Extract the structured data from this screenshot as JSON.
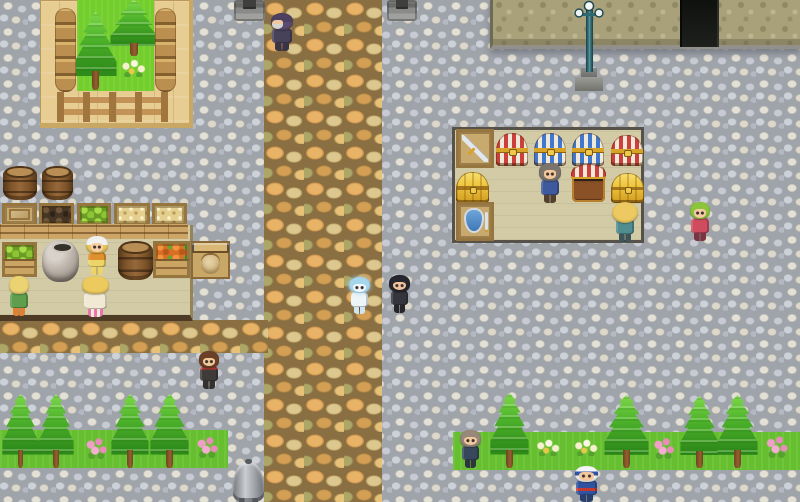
{
  "scene": {
    "width": 800,
    "height": 502,
    "style": "rpg-town"
  },
  "terrain": [
    {
      "name": "ground-cobblestone",
      "cls": "t-cobble",
      "x": 0,
      "y": 0,
      "w": 800,
      "h": 502,
      "z": 1,
      "interactable": false,
      "colors": {
        "base": "#9fa3aa"
      }
    },
    {
      "name": "main-path",
      "cls": "t-path",
      "x": 264,
      "y": 0,
      "w": 118,
      "h": 502,
      "z": 2,
      "interactable": false,
      "colors": {
        "base": "#8a6f42"
      }
    },
    {
      "name": "west-road",
      "cls": "t-path",
      "x": 0,
      "y": 320,
      "w": 268,
      "h": 33,
      "z": 2,
      "interactable": false,
      "colors": {
        "base": "#8a6f42"
      }
    },
    {
      "name": "grass-strip-left",
      "cls": "t-grass",
      "x": 0,
      "y": 430,
      "w": 228,
      "h": 38,
      "z": 2,
      "interactable": false,
      "colors": {
        "base": "#66bf2e"
      }
    },
    {
      "name": "grass-strip-right",
      "cls": "t-grass",
      "x": 453,
      "y": 432,
      "w": 347,
      "h": 38,
      "z": 2,
      "interactable": false,
      "colors": {
        "base": "#66bf2e"
      }
    },
    {
      "name": "garden-deck",
      "cls": "t-deck",
      "x": 40,
      "y": 0,
      "w": 153,
      "h": 128,
      "z": 3,
      "interactable": false,
      "colors": {
        "base": "#e7cd92"
      }
    },
    {
      "name": "garden-grass",
      "cls": "t-ggrass",
      "x": 77,
      "y": 0,
      "w": 77,
      "h": 91,
      "z": 4,
      "interactable": false,
      "colors": {
        "base": "#72ce2b"
      }
    },
    {
      "name": "market-floor",
      "cls": "t-floor floor-market",
      "x": 0,
      "y": 225,
      "w": 193,
      "h": 96,
      "z": 3,
      "interactable": false,
      "colors": {
        "base": "#d2cba6"
      }
    },
    {
      "name": "shop-floor",
      "cls": "t-floor floor-shop",
      "x": 452,
      "y": 127,
      "w": 192,
      "h": 116,
      "z": 3,
      "interactable": false,
      "colors": {
        "base": "#d2cba6"
      }
    },
    {
      "name": "building-wall",
      "cls": "t-wall",
      "x": 490,
      "y": 0,
      "w": 310,
      "h": 49,
      "z": 5,
      "interactable": false,
      "colors": {
        "base": "#a8a17a"
      }
    },
    {
      "name": "building-doorway",
      "cls": "t-door",
      "x": 680,
      "y": 0,
      "w": 39,
      "h": 47,
      "z": 6,
      "interactable": true,
      "colors": {
        "base": "#171a17"
      }
    }
  ],
  "props": [
    {
      "name": "garden-log-edge-left",
      "cls": "p-logs",
      "x": 55,
      "y": 8,
      "w": 21,
      "h": 84,
      "interactable": false
    },
    {
      "name": "garden-log-edge-right",
      "cls": "p-logs",
      "x": 155,
      "y": 8,
      "w": 21,
      "h": 84,
      "interactable": false
    },
    {
      "name": "garden-pine-tree-back",
      "cls": "p-pine",
      "x": 110,
      "y": 0,
      "w": 48,
      "h": 56,
      "interactable": false
    },
    {
      "name": "garden-pine-tree-front",
      "cls": "p-pine",
      "x": 74,
      "y": 12,
      "w": 43,
      "h": 78,
      "interactable": false
    },
    {
      "name": "garden-flowers",
      "cls": "p-flower-white",
      "x": 119,
      "y": 59,
      "w": 28,
      "h": 18,
      "interactable": false
    },
    {
      "name": "garden-fence",
      "cls": "p-fence",
      "x": 57,
      "y": 92,
      "w": 111,
      "h": 30,
      "interactable": false
    },
    {
      "name": "market-barrel-1",
      "cls": "p-barrel",
      "x": 3,
      "y": 168,
      "w": 34,
      "h": 32,
      "interactable": false
    },
    {
      "name": "market-barrel-2",
      "cls": "p-barrel",
      "x": 42,
      "y": 168,
      "w": 31,
      "h": 32,
      "interactable": false
    },
    {
      "name": "market-counter-front",
      "cls": "p-counter",
      "x": 0,
      "y": 224,
      "w": 188,
      "h": 15,
      "interactable": false
    },
    {
      "name": "market-crate-closed",
      "cls": "p-crate fill-closed",
      "x": 2,
      "y": 203,
      "w": 35,
      "h": 23,
      "interactable": true
    },
    {
      "name": "market-crate-dark-goods",
      "cls": "p-crate fill-dark",
      "x": 39,
      "y": 203,
      "w": 35,
      "h": 23,
      "interactable": true
    },
    {
      "name": "market-crate-apples",
      "cls": "p-crate fill-apples",
      "x": 77,
      "y": 203,
      "w": 34,
      "h": 23,
      "interactable": true
    },
    {
      "name": "market-crate-wheat-1",
      "cls": "p-crate fill-wheat",
      "x": 114,
      "y": 203,
      "w": 36,
      "h": 23,
      "interactable": true
    },
    {
      "name": "market-crate-wheat-2",
      "cls": "p-crate fill-wheat",
      "x": 152,
      "y": 203,
      "w": 35,
      "h": 23,
      "interactable": true
    },
    {
      "name": "market-crate-apples-floor",
      "cls": "p-crate fill-apples crate-tall",
      "x": 2,
      "y": 242,
      "w": 35,
      "h": 35,
      "interactable": true
    },
    {
      "name": "market-ceramic-pot",
      "cls": "p-pot",
      "x": 42,
      "y": 240,
      "w": 37,
      "h": 42,
      "interactable": false
    },
    {
      "name": "market-barrel-3",
      "cls": "p-barrel",
      "x": 118,
      "y": 243,
      "w": 35,
      "h": 37,
      "interactable": false
    },
    {
      "name": "market-crate-carrots",
      "cls": "p-crate fill-carrots crate-tall",
      "x": 153,
      "y": 241,
      "w": 37,
      "h": 37,
      "interactable": true
    },
    {
      "name": "market-sack-stand",
      "cls": "p-stand",
      "x": 191,
      "y": 241,
      "w": 39,
      "h": 38,
      "interactable": true
    },
    {
      "name": "shop-crate-sword",
      "cls": "p-crate fill-sword",
      "x": 456,
      "y": 129,
      "w": 38,
      "h": 39,
      "interactable": true
    },
    {
      "name": "shop-chest-red-1",
      "cls": "p-chest chest-red",
      "x": 496,
      "y": 133,
      "w": 32,
      "h": 33,
      "interactable": true
    },
    {
      "name": "shop-chest-blue-1",
      "cls": "p-chest chest-blue",
      "x": 534,
      "y": 133,
      "w": 32,
      "h": 33,
      "interactable": true
    },
    {
      "name": "shop-chest-blue-2",
      "cls": "p-chest chest-blue",
      "x": 572,
      "y": 133,
      "w": 32,
      "h": 33,
      "interactable": true
    },
    {
      "name": "shop-chest-red-2",
      "cls": "p-chest chest-red",
      "x": 611,
      "y": 135,
      "w": 32,
      "h": 31,
      "interactable": true
    },
    {
      "name": "shop-chest-gold-1",
      "cls": "p-chest chest-gold",
      "x": 456,
      "y": 172,
      "w": 33,
      "h": 31,
      "interactable": true
    },
    {
      "name": "shop-chest-open-red",
      "cls": "p-chest chest-open",
      "x": 572,
      "y": 167,
      "w": 33,
      "h": 35,
      "interactable": true
    },
    {
      "name": "shop-chest-gold-2",
      "cls": "p-chest chest-gold",
      "x": 611,
      "y": 173,
      "w": 33,
      "h": 30,
      "interactable": true
    },
    {
      "name": "shop-crate-shield",
      "cls": "p-crate fill-shield",
      "x": 456,
      "y": 202,
      "w": 38,
      "h": 39,
      "interactable": true
    },
    {
      "name": "stone-pedestal-left",
      "cls": "p-pedestal",
      "x": 234,
      "y": 0,
      "w": 31,
      "h": 21,
      "interactable": false
    },
    {
      "name": "stone-pedestal-right",
      "cls": "p-pedestal",
      "x": 387,
      "y": 0,
      "w": 30,
      "h": 21,
      "interactable": false
    },
    {
      "name": "lamppost",
      "cls": "p-lamp",
      "x": 570,
      "y": 0,
      "w": 38,
      "h": 91,
      "interactable": false
    },
    {
      "name": "pine-tree-sw-1",
      "cls": "p-pine",
      "x": 2,
      "y": 394,
      "w": 37,
      "h": 74,
      "interactable": false
    },
    {
      "name": "pine-tree-sw-2",
      "cls": "p-pine",
      "x": 38,
      "y": 394,
      "w": 36,
      "h": 74,
      "interactable": false
    },
    {
      "name": "pine-tree-sw-3",
      "cls": "p-pine",
      "x": 111,
      "y": 394,
      "w": 38,
      "h": 74,
      "interactable": false
    },
    {
      "name": "pine-tree-sw-4",
      "cls": "p-pine",
      "x": 150,
      "y": 394,
      "w": 39,
      "h": 74,
      "interactable": false
    },
    {
      "name": "pine-tree-se-1",
      "cls": "p-pine",
      "x": 490,
      "y": 393,
      "w": 39,
      "h": 75,
      "interactable": false
    },
    {
      "name": "pine-tree-se-2",
      "cls": "p-pine",
      "x": 604,
      "y": 395,
      "w": 45,
      "h": 73,
      "interactable": false
    },
    {
      "name": "pine-tree-se-3",
      "cls": "p-pine",
      "x": 680,
      "y": 396,
      "w": 39,
      "h": 72,
      "interactable": false
    },
    {
      "name": "pine-tree-se-4",
      "cls": "p-pine",
      "x": 717,
      "y": 395,
      "w": 41,
      "h": 73,
      "interactable": false
    },
    {
      "name": "flowers-pink-1",
      "cls": "p-flower-pink",
      "x": 84,
      "y": 437,
      "w": 24,
      "h": 22,
      "interactable": false
    },
    {
      "name": "flowers-pink-2",
      "cls": "p-flower-pink",
      "x": 195,
      "y": 436,
      "w": 24,
      "h": 22,
      "interactable": false
    },
    {
      "name": "flowers-white-1",
      "cls": "p-flower-white",
      "x": 534,
      "y": 439,
      "w": 27,
      "h": 17,
      "interactable": false
    },
    {
      "name": "flowers-white-2",
      "cls": "p-flower-white",
      "x": 572,
      "y": 439,
      "w": 27,
      "h": 17,
      "interactable": false
    },
    {
      "name": "flowers-pink-3",
      "cls": "p-flower-pink",
      "x": 652,
      "y": 437,
      "w": 23,
      "h": 22,
      "interactable": false
    },
    {
      "name": "flowers-pink-4",
      "cls": "p-flower-pink",
      "x": 764,
      "y": 435,
      "w": 25,
      "h": 23,
      "interactable": false
    },
    {
      "name": "armor-statue",
      "cls": "p-armor",
      "x": 233,
      "y": 461,
      "w": 31,
      "h": 41,
      "interactable": true
    }
  ],
  "characters": [
    {
      "name": "npc-old-man",
      "x": 267,
      "y": 13,
      "w": 30,
      "h": 38,
      "facing": "left",
      "interactable": true,
      "colors": {
        "hair": "#4e4060",
        "hair2": "#5a4c6e",
        "skin": "#efc9a2",
        "top": "#48415a",
        "bot": "#3a3448"
      }
    },
    {
      "name": "npc-maid-shopkeeper",
      "x": 83,
      "y": 236,
      "w": 28,
      "h": 39,
      "facing": "down",
      "interactable": true,
      "colors": {
        "hair": "#f1f1ee",
        "hair2": "#e9c457",
        "skin": "#f6cfa6",
        "top": "#df9130",
        "bot": "#ecd469"
      }
    },
    {
      "name": "npc-customer-woman",
      "x": 78,
      "y": 276,
      "w": 35,
      "h": 41,
      "facing": "up",
      "interactable": true,
      "colors": {
        "hair": "#ecca5e",
        "skin": "#f6cfa6",
        "top": "#f1e9d4",
        "bot": "#e9b6cf"
      }
    },
    {
      "name": "npc-blonde-kid",
      "x": 6,
      "y": 276,
      "w": 26,
      "h": 40,
      "facing": "up",
      "interactable": true,
      "colors": {
        "hair": "#ecd372",
        "skin": "#f6cfa6",
        "top": "#5f9e4d",
        "bot": "#e08030"
      }
    },
    {
      "name": "npc-spirit",
      "x": 346,
      "y": 277,
      "w": 27,
      "h": 37,
      "facing": "down",
      "interactable": true,
      "colors": {
        "hair": "#a6d6ee",
        "skin": "#eef8fd",
        "top": "#edf5f7",
        "bot": "#cde6ef"
      }
    },
    {
      "name": "npc-dark-haired-man",
      "x": 386,
      "y": 275,
      "w": 27,
      "h": 38,
      "facing": "down",
      "interactable": true,
      "colors": {
        "hair": "#26262e",
        "skin": "#efc49e",
        "top": "#35353d",
        "bot": "#26262a"
      }
    },
    {
      "name": "npc-red-scarf-man",
      "x": 196,
      "y": 351,
      "w": 26,
      "h": 38,
      "facing": "down",
      "interactable": true,
      "colors": {
        "hair": "#6b4026",
        "skin": "#f2c89c",
        "top": "#3f3b38",
        "bot": "#33302e"
      }
    },
    {
      "name": "npc-shop-owner",
      "x": 536,
      "y": 163,
      "w": 28,
      "h": 40,
      "facing": "down",
      "interactable": true,
      "colors": {
        "hair": "#7b756e",
        "skin": "#f2c89c",
        "top": "#3e5a9e",
        "bot": "#533f2c"
      }
    },
    {
      "name": "npc-afro-customer",
      "x": 611,
      "y": 202,
      "w": 28,
      "h": 40,
      "facing": "up",
      "interactable": true,
      "colors": {
        "hair": "#ecc961",
        "skin": "#f2c89c",
        "top": "#4f8d90",
        "bot": "#3c5558"
      }
    },
    {
      "name": "npc-green-haired-girl",
      "x": 687,
      "y": 202,
      "w": 26,
      "h": 39,
      "facing": "down",
      "interactable": true,
      "colors": {
        "hair": "#8cc43c",
        "skin": "#f4cba2",
        "top": "#cf4b5e",
        "bot": "#7c3440"
      }
    },
    {
      "name": "npc-gray-haired-man",
      "x": 457,
      "y": 430,
      "w": 27,
      "h": 38,
      "facing": "down",
      "interactable": true,
      "colors": {
        "hair": "#98887a",
        "skin": "#f0c9a0",
        "top": "#39475c",
        "bot": "#2e3540"
      }
    },
    {
      "name": "npc-soldier",
      "x": 571,
      "y": 466,
      "w": 31,
      "h": 36,
      "facing": "down",
      "interactable": true,
      "colors": {
        "hair": "#f4f6f8",
        "hair2": "#2f55aa",
        "skin": "#f2c89c",
        "top": "#31539f",
        "bot": "#27406e"
      }
    }
  ]
}
